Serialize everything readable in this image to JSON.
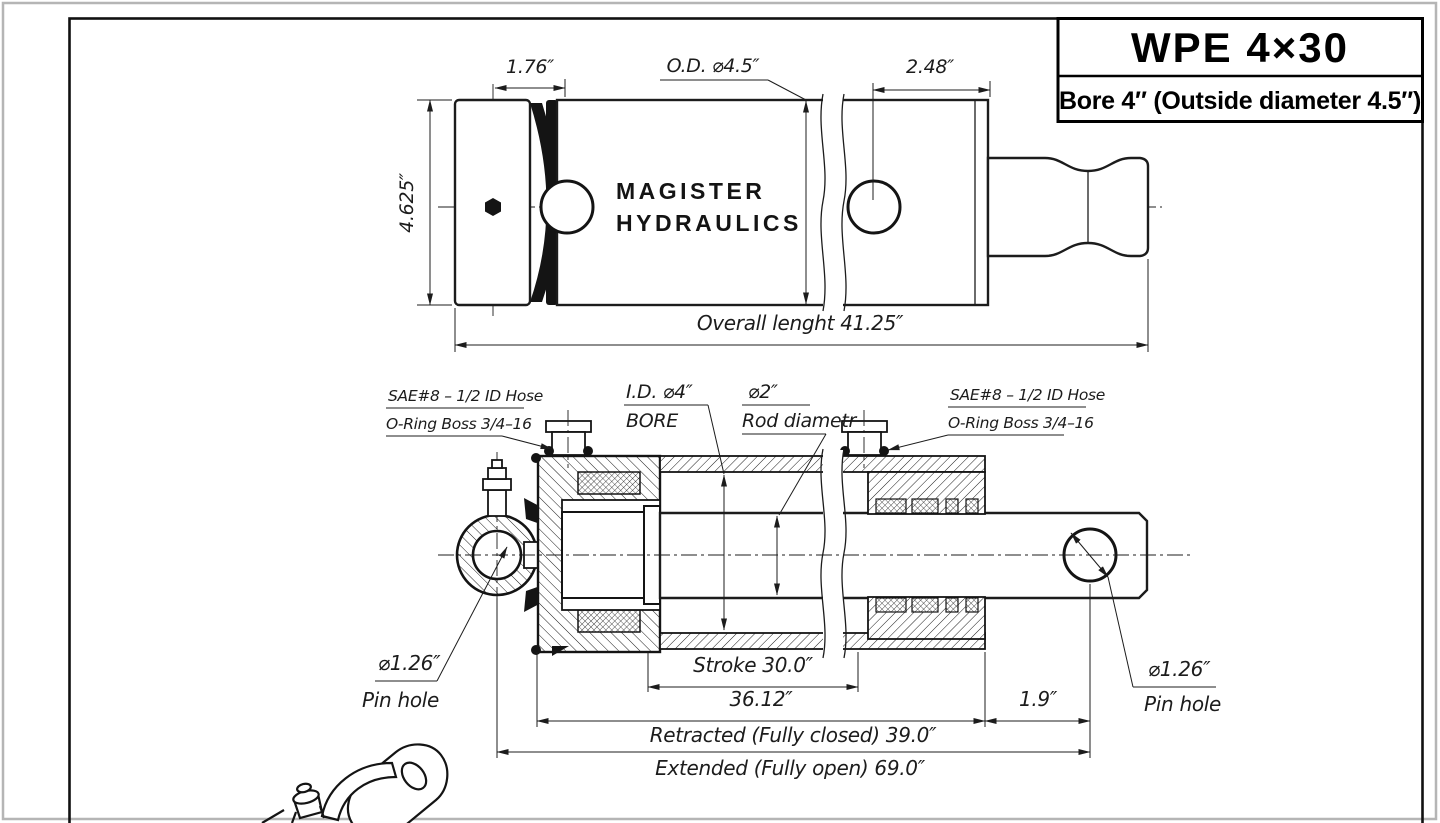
{
  "title_block": {
    "model": "WPE 4×30",
    "subtitle": "Bore 4″ (Outside diameter 4.5″)"
  },
  "top_view": {
    "brand_line1": "MAGISTER",
    "brand_line2": "HYDRAULICS",
    "dim_pivot_to_face": "1.76″",
    "dim_outer_diameter": "O.D. ⌀4.5″",
    "dim_rod_extension": "2.48″",
    "dim_body_height": "4.625″",
    "dim_overall_length": "Overall lenght 41.25″"
  },
  "section_view": {
    "port_label_line1": "SAE#8 – 1/2 ID Hose",
    "port_label_line2": "O-Ring Boss 3/4–16",
    "bore_label_line1": "I.D. ⌀4″",
    "bore_label_line2": "BORE",
    "rod_label_line1": "⌀2″",
    "rod_label_line2": "Rod diametr",
    "dim_stroke": "Stroke 30.0″",
    "dim_closed_body": "36.12″",
    "dim_rod_protrusion": "1.9″",
    "dim_retracted": "Retracted (Fully closed) 39.0″",
    "dim_extended": "Extended (Fully open) 69.0″",
    "pin_hole_diameter": "⌀1.26″",
    "pin_hole_label": "Pin hole"
  }
}
